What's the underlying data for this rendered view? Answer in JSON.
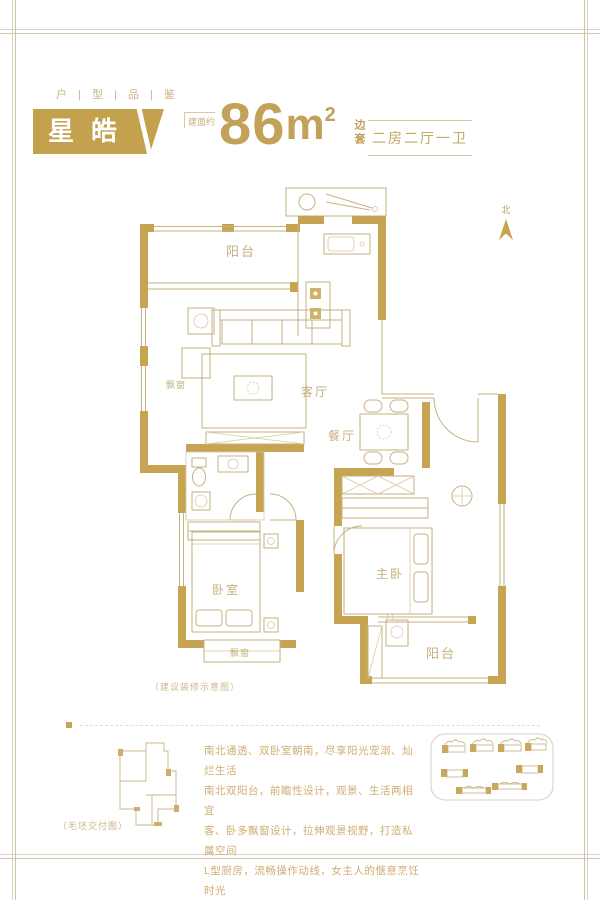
{
  "colors": {
    "gold": "#C6A452",
    "plan_line": "#C6B282",
    "text_gold": "#CFAD72",
    "frame_outer": "#DAD3C3",
    "frame_inner": "#CFC5A6"
  },
  "header": {
    "eyebrow": "户 | 型 | 品 | 鉴",
    "unit_name": "星皓",
    "area_label": "建面约",
    "area_number": "86",
    "area_unit": "m",
    "area_exponent": "2",
    "position_tag": "边套",
    "layout_tag": "二房二厅一卫"
  },
  "compass": {
    "north_label": "北"
  },
  "plan": {
    "rooms": {
      "balcony_top": "阳台",
      "living_room": "客厅",
      "dining_room": "餐厅",
      "bay_window_left": "飘窗",
      "bedroom": "卧室",
      "master_bedroom": "主卧",
      "bay_window_bottom": "飘窗",
      "balcony_bottom": "阳台"
    },
    "caption": "（建议装修示意图）"
  },
  "footer": {
    "mini_plan_caption": "（毛坯交付图）",
    "description_lines": [
      "南北通透、双卧室朝南，尽享阳光宠溺、灿烂生活",
      "南北双阳台，前瞻性设计，观景、生活两相宜",
      "客、卧多飘窗设计，拉伸观景视野，打造私属空间",
      "L型厨房，流畅操作动线，女主人的惬意烹饪时光"
    ]
  }
}
